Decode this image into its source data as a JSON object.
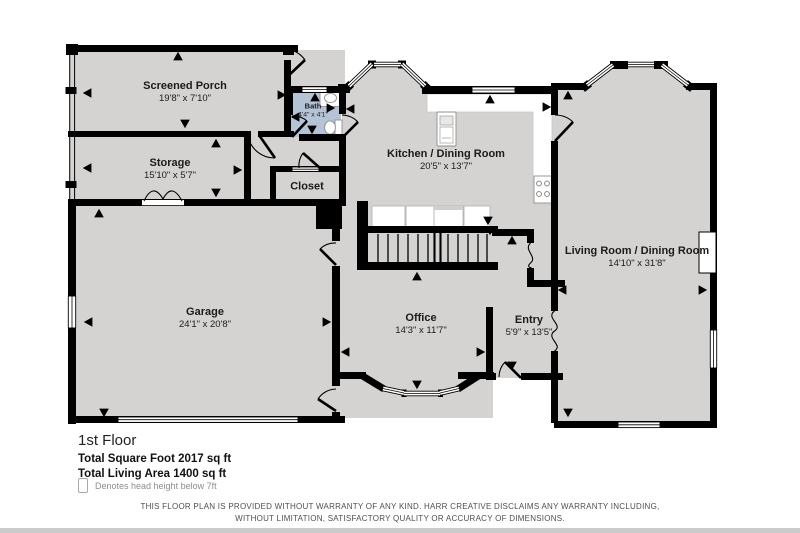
{
  "plan": {
    "rooms": [
      {
        "id": "screened-porch",
        "name": "Screened Porch",
        "dims": "19'8\" x 7'10\""
      },
      {
        "id": "storage",
        "name": "Storage",
        "dims": "15'10\" x 5'7\""
      },
      {
        "id": "bath",
        "name": "Bath",
        "dims": "4'4\" x 4'1\""
      },
      {
        "id": "closet",
        "name": "Closet",
        "dims": ""
      },
      {
        "id": "kitchen-dining",
        "name": "Kitchen / Dining Room",
        "dims": "20'5\" x 13'7\""
      },
      {
        "id": "living-dining",
        "name": "Living Room / Dining Room",
        "dims": "14'10\" x 31'8\""
      },
      {
        "id": "garage",
        "name": "Garage",
        "dims": "24'1\" x 20'8\""
      },
      {
        "id": "office",
        "name": "Office",
        "dims": "14'3\" x 11'7\""
      },
      {
        "id": "entry",
        "name": "Entry",
        "dims": "5'9\" x 13'5\""
      }
    ]
  },
  "footer": {
    "floor_label": "1st Floor",
    "total_square_foot": "Total Square Foot 2017 sq ft",
    "total_living_area": "Total Living Area 1400 sq ft",
    "legend_note": "Denotes head height below 7ft"
  },
  "disclaimer": {
    "line1": "THIS FLOOR PLAN IS PROVIDED WITHOUT WARRANTY OF ANY KIND. HARR CREATIVE DISCLAIMS ANY WARRANTY INCLUDING,",
    "line2": "WITHOUT LIMITATION, SATISFACTORY QUALITY OR ACCURACY OF DIMENSIONS."
  },
  "colors": {
    "wall": "#000000",
    "floor": "#d5d3d1",
    "bath_floor": "#b4c3d6",
    "fixture": "#ffffff",
    "legend_text": "#8d8d8d"
  }
}
